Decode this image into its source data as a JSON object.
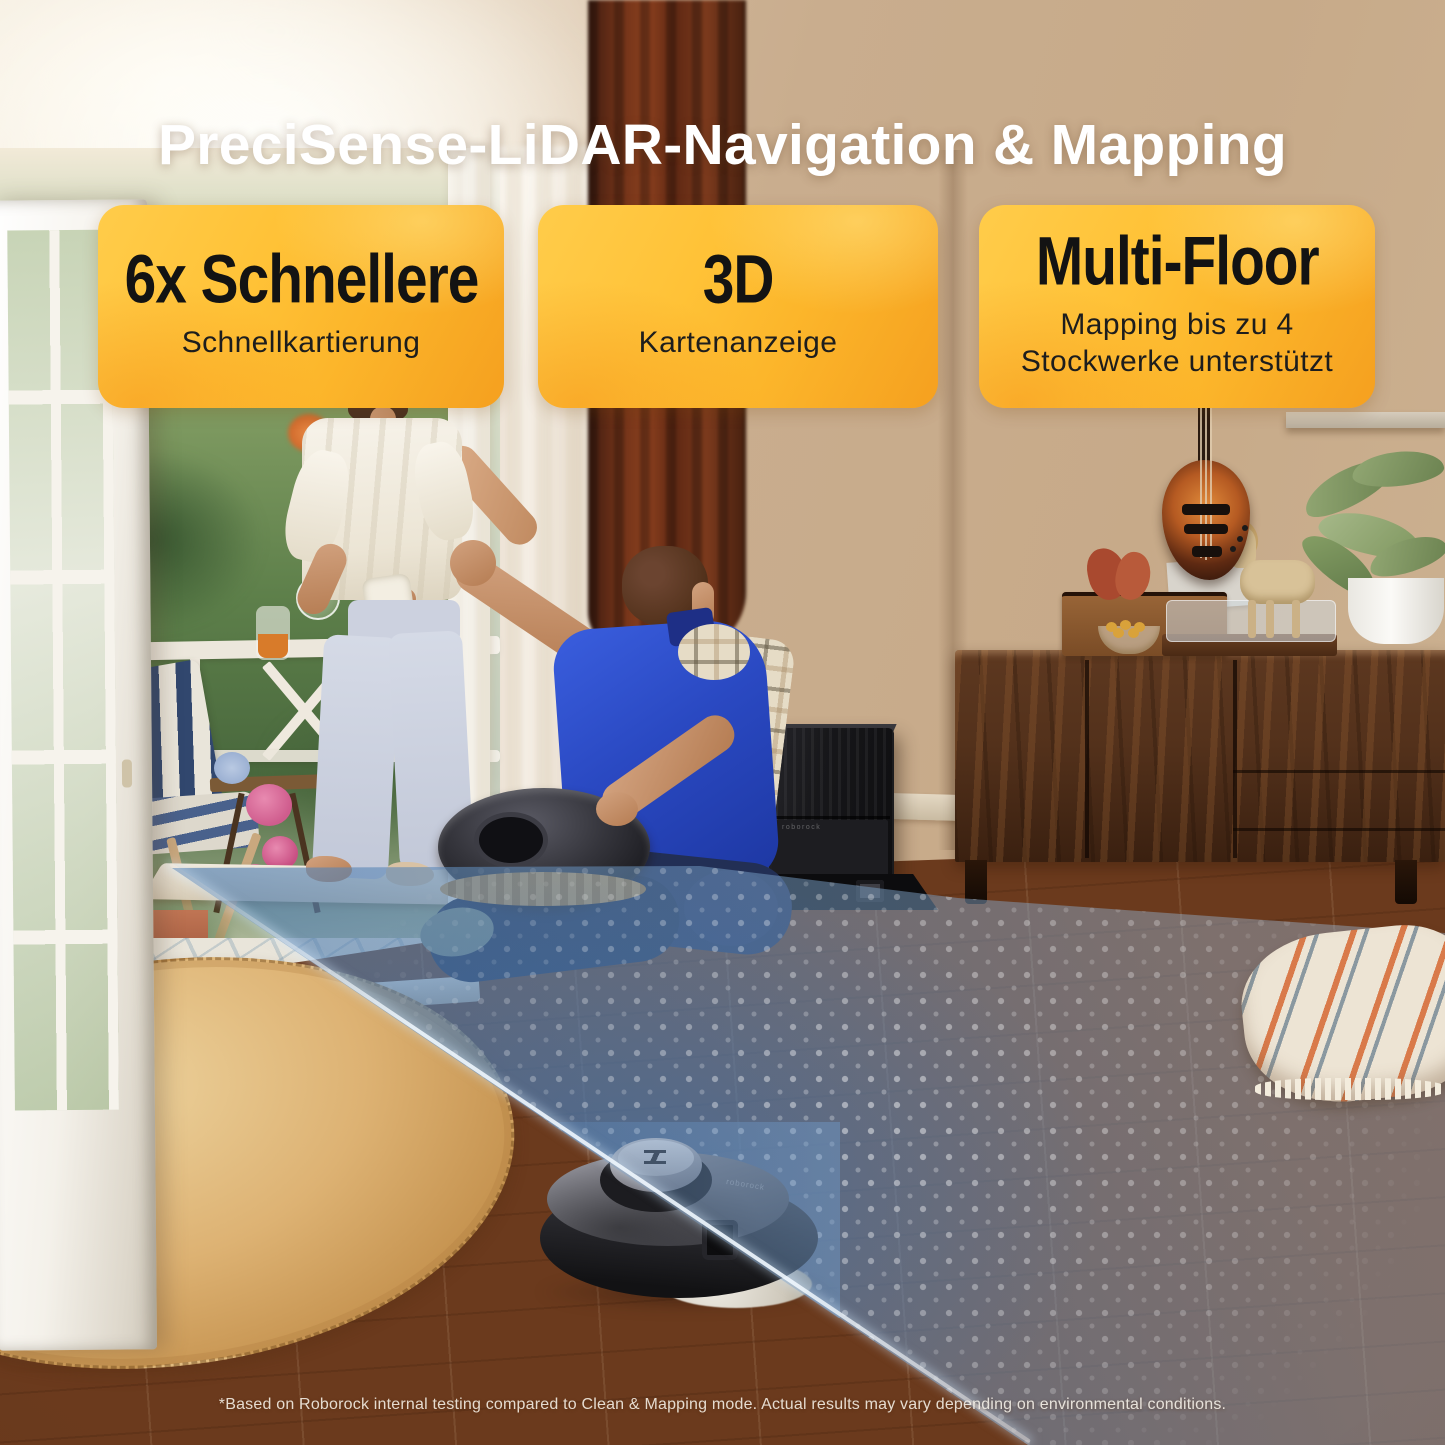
{
  "page": {
    "headline": "PreciSense-LiDAR-Navigation & Mapping",
    "disclaimer": "*Based on Roborock internal testing compared to Clean & Mapping mode.  Actual results may vary depending on environmental conditions."
  },
  "feature_cards": [
    {
      "title": "6x Schnellere",
      "subtitle": "Schnellkartierung"
    },
    {
      "title": "3D",
      "subtitle": "Kartenanzeige"
    },
    {
      "title": "Multi-Floor",
      "subtitle": "Mapping bis zu 4 Stockwerke unterstützt"
    }
  ],
  "branding": {
    "wordmark": "roborock"
  },
  "colors": {
    "headline_text": "#ffffff",
    "card_gradient_start": "#ffcc4a",
    "card_gradient_mid": "#ffc237",
    "card_gradient_end": "#f5a01f",
    "card_text": "#131313",
    "lidar_beam": "#5f8fc0",
    "beam_edge_line": "#e9f2fb",
    "wood_floor": "#b97e4c",
    "curtain": "#6e3118"
  },
  "scene_elements": [
    "robot-vacuum",
    "lidar-beam",
    "dock-station",
    "area-rug",
    "wood-floor",
    "sideboard",
    "bass-guitar",
    "house-plant",
    "turntable",
    "throw-blanket",
    "patio-door",
    "outdoor-chair",
    "woman-figure",
    "man-figure",
    "handpan-drum"
  ]
}
